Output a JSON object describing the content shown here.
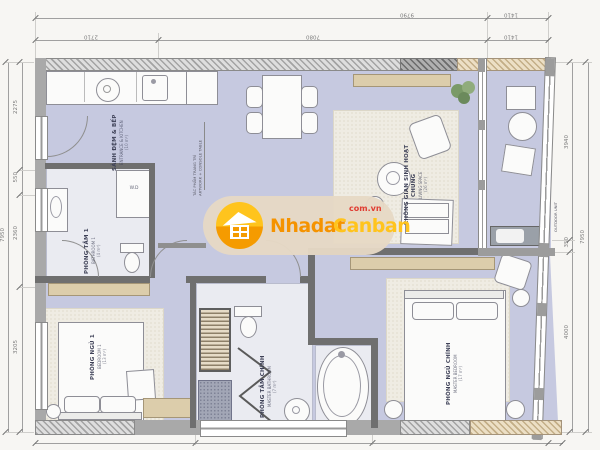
{
  "watermark": {
    "brand_a": "Nhadat",
    "brand_b": "Canban",
    "domain": "com.vn"
  },
  "rooms": {
    "kitchen": {
      "name": "SẢNH ĐỆM & BẾP",
      "subtitle": "ENTRANCE & KITCHEN",
      "area": "(10 m²)"
    },
    "living": {
      "name": "KHÔNG GIAN SINH HOẠT CHUNG",
      "subtitle": "LIVING SPACE",
      "area": "(26 m²)"
    },
    "bathroom1": {
      "name": "PHÒNG TẮM 1",
      "subtitle": "BATHROOM 1",
      "area": "(4 m²)"
    },
    "bedroom1": {
      "name": "PHÒNG NGỦ 1",
      "subtitle": "BEDROOM 1",
      "area": "(13 m²)"
    },
    "master_bathroom": {
      "name": "PHÒNG TẮM CHÍNH",
      "subtitle": "MASTER BATHROOM",
      "area": "(7 m²)"
    },
    "master_bedroom": {
      "name": "PHÒNG NGỦ CHÍNH",
      "subtitle": "MASTER BEDROOM",
      "area": "(17 m²)"
    }
  },
  "annotations": {
    "artwork_line1": "TÁC PHẨM TRANG TRÍ",
    "artwork_line2": "ARTWORK + CONSOLE TABLE",
    "outdoor_unit": "OUTDOOR UNIT",
    "washer": "W.D"
  },
  "dimensions": {
    "top_total": "9790",
    "top_right": "1410",
    "top_seg1": "2710",
    "top_seg2": "7080",
    "top_seg3": "1410",
    "left_seg1": "2275",
    "left_seg2": "550",
    "left_seg3": "2360",
    "left_seg4": "3205",
    "left_total": "7950",
    "right_seg1": "3940",
    "right_seg2": "350",
    "right_seg3": "4000",
    "right_total": "7950"
  },
  "colors": {
    "floor": "#c6c9e0",
    "wall": "#6f6f6f",
    "rug": "#efece3",
    "wood": "#dccdab",
    "accent_orange": "#f59300",
    "accent_yellow": "#ffc41d",
    "accent_red": "#e03c31"
  }
}
